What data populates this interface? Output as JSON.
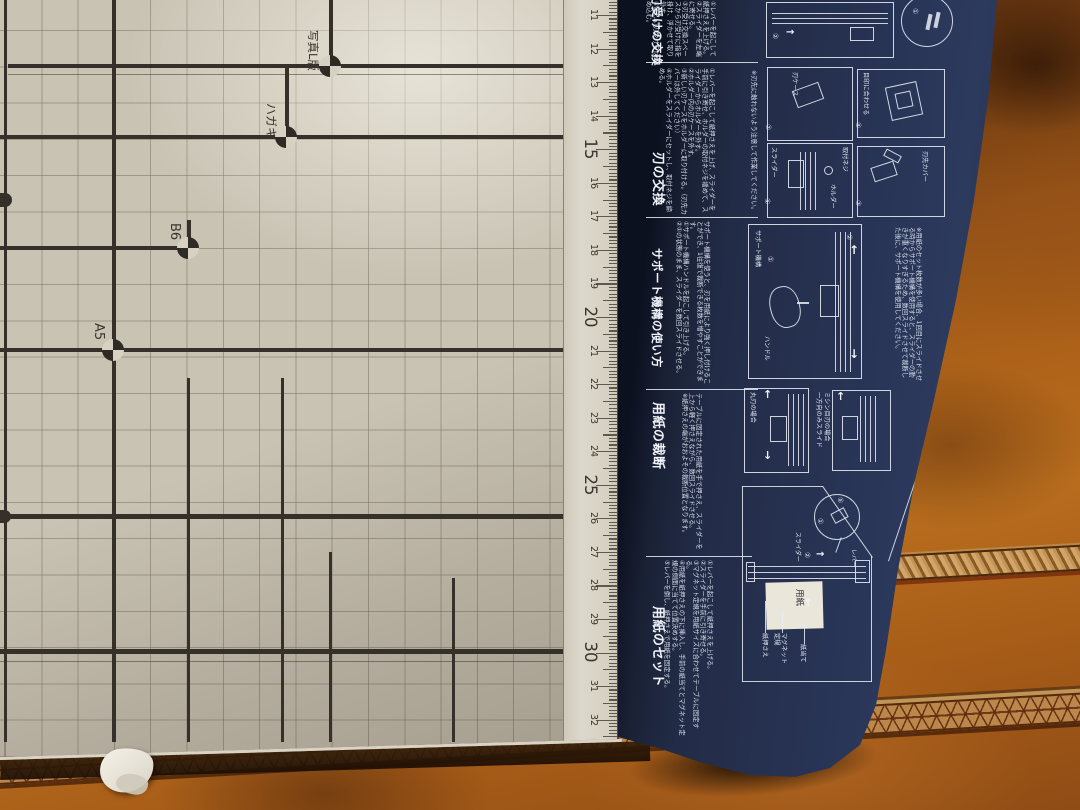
{
  "board": {
    "size_labels": [
      {
        "text": "写真L版"
      },
      {
        "text": "ハガキ"
      },
      {
        "text": "B6"
      },
      {
        "text": "A5"
      }
    ],
    "ruler": {
      "numbers": [
        11,
        12,
        13,
        14,
        15,
        16,
        17,
        18,
        19,
        20,
        21,
        22,
        23,
        24,
        25,
        26,
        27,
        28,
        29,
        30,
        31,
        32
      ],
      "major_every": 5
    }
  },
  "panel": {
    "icons": {
      "arrow_up": "↑",
      "arrow_down": "↓",
      "arrow_right": "→"
    },
    "sections": [
      {
        "title": "刃受けの交換",
        "body": "①レバーを起こして紙押さえを上げる。\n②スライダーを左端に寄せる。\n③刃受け交換スペースから刃受けに指を掛け、浮かせて取り外す。\n④新しい刃受けをはめ込む。",
        "digits": {
          "d1": "①",
          "d2": "②"
        }
      },
      {
        "title": "刃の交換",
        "body": "①レバーを起こして紙押さえを上げ、スライダーを手前に引き寄せ、ホルダーの取付ネジを緩めて、スライダーからホルダーを外す。\n②ホルダー内の刃ケースを外す。\n③新しい刃ケースをホルダーに取り付ける。（刃先カバーは外してください）\n④ホルダーをスライダーにセットし、取付ネジを締める。",
        "note": "※刃先に触れないよう注意して作業してください。",
        "labels": {
          "slider": "スライダー",
          "holder": "ホルダー",
          "screw": "取付ネジ",
          "blade_case": "刃ケース",
          "blade_cover": "刃先カバー",
          "align_mark": "目印に合わせる"
        },
        "digits": {
          "d1": "①",
          "d2": "②",
          "d3": "③",
          "d4": "④"
        }
      },
      {
        "title": "サポート機構の使い方",
        "body": "サポート機構を使うと、刃を用紙により強く押し付けることができ、1往復で裁断できる枚数を増やすことができます。\n①サポート機構ハンドルを起こして引き上げる。\n②①の状態のまま、スライダーを数回スライドさせる。",
        "note": "※用紙のセット枚数が多い場合、1回目にスライドさせる時からサポート機構を使用すると、スライダーの動きが重くなりすぎるため、数回スライドさせて裁断した後に、サポート機構を使用してください。",
        "labels": {
          "handle": "ハンドル",
          "support": "サポート機構"
        },
        "digits": {
          "d1": "①",
          "d2": "②"
        }
      },
      {
        "title": "用紙の裁断",
        "body": "テーブルに固定された用紙を手で押さえ、スライダーを上から軽く押さえながら、数回スライドさせる。\n※紙押さえの端がおおよその裁断位置となります。",
        "labels": {
          "round_blade": "丸刃の場合",
          "perf_blade": "ミシン目刃の場合",
          "one_way": "一方向のみスライド"
        }
      },
      {
        "title": "用紙のセット",
        "body": "①レバーを起こして紙押さえを上げる。\n②スライダーを手前に引き寄せる。\n③マグネット定規を用紙サイズに合わせてテーブルに固定する。\n④用紙を紙押さえの下に挿入し、手前の紙当てとマグネット定規の側面に当てて位置決めする。\n⑤レバーを倒し、紙押さえで用紙を固定する。",
        "labels": {
          "paper_press": "紙押さえ",
          "magnet_rule": "マグネット定規",
          "paper_guide": "紙当て",
          "slider": "スライダー",
          "lever": "レバー",
          "paper": "用紙"
        },
        "digits": {
          "d1": "①",
          "d2": "②",
          "d3": "③",
          "d4": "④",
          "d5": "⑤"
        }
      }
    ]
  }
}
